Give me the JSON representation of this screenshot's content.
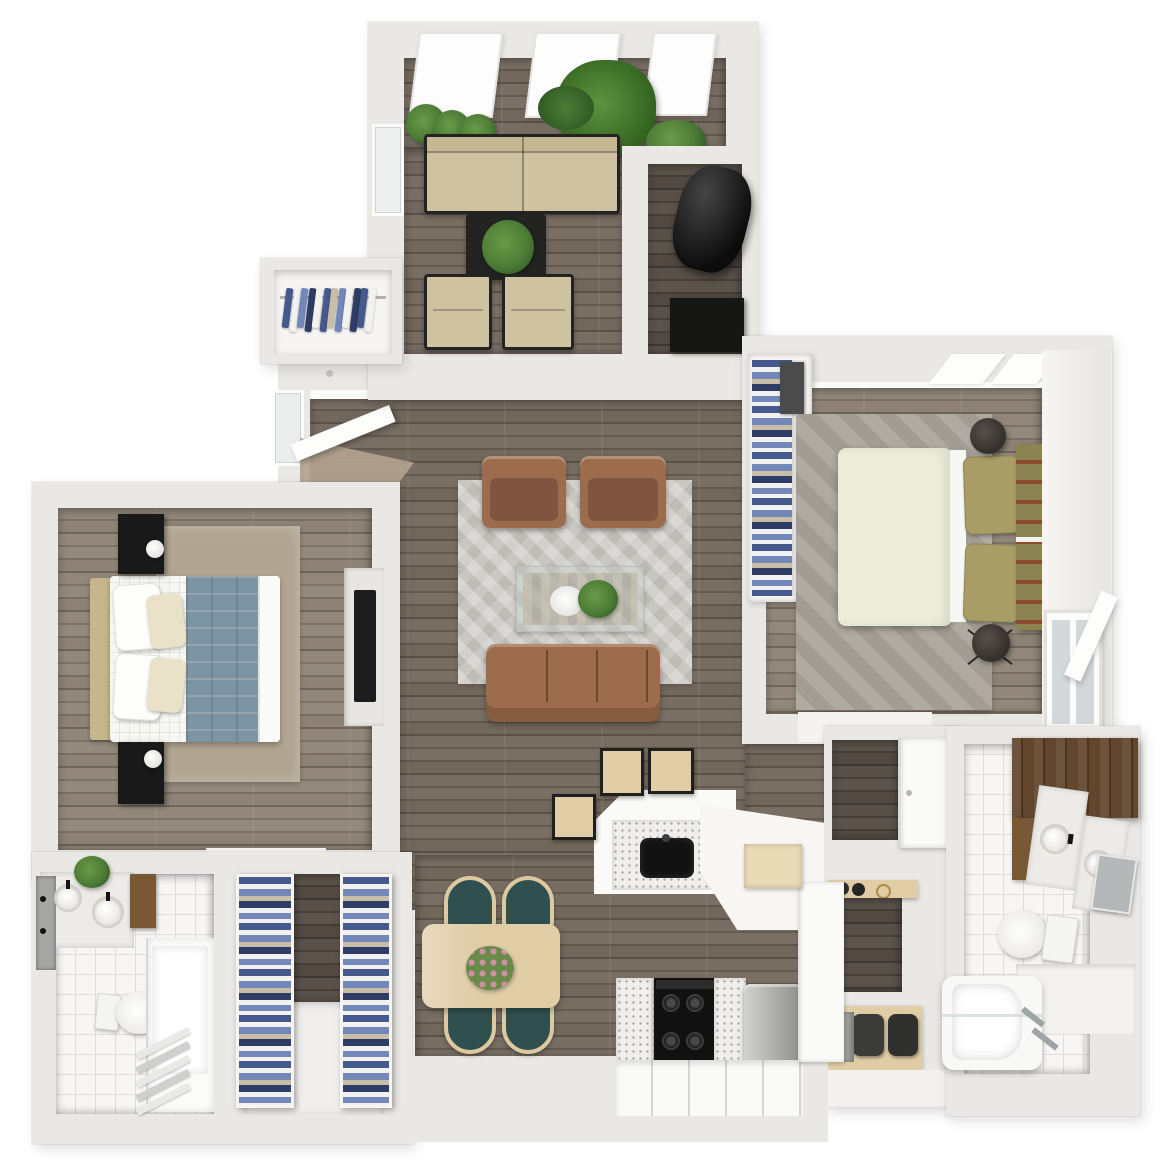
{
  "title": "3d-apartment-floor-plan-render",
  "palette": {
    "bg": "#ffffff",
    "wall": "#eae8e4",
    "wallLight": "#f5f4f2",
    "wallFace": "#fbfbf9",
    "woodBase": "#6f6459",
    "woodLight": "#8b8072",
    "woodDarker": "#4f463e",
    "woodEntry": "#b2a28e",
    "rugLiving": "#c9c7c2",
    "rugBeige": "#b1a591",
    "rugGray": "#a29c93",
    "sofaBrown": "#9c6c4c",
    "sofaBrownDark": "#7f5540",
    "beigeSofa": "#cfc2a0",
    "beigeSeat": "#c4b691",
    "frameBlack": "#232321",
    "plantGreen": "#4d7c36",
    "plantDark": "#335c26",
    "bedCream": "#ecedd9",
    "oliveHead": "#8c8352",
    "olivePillow": "#a89d67",
    "rust": "#8a4c2a",
    "bedWhite": "#f6f6f3",
    "throwBlue": "#7d94a2",
    "headTan": "#c7b68c",
    "tile": "#f7f6f5",
    "tileLine": "#e1deda",
    "marble": "#edebe7",
    "walnut": "#5c4026",
    "walnutLight": "#7a5836",
    "steel": "#a9a9a7",
    "stoveBlack": "#111111",
    "speckleBase": "#efeeeb",
    "cabinetWhite": "#fafaf8",
    "tableWood": "#e0cda6",
    "tableWoodLight": "#e9dab6",
    "chairTeal": "#30504f",
    "linenBlue": "#46598c",
    "linenBlue2": "#7388b8",
    "linenWhite": "#f1f1ef",
    "linenTan": "#c8bea7",
    "navy": "#2e3c66",
    "blackish": "#161614",
    "glassBlue": "#d3d9db",
    "mirrorGray": "#a5a5a3"
  },
  "scene": {
    "type": "apartment-floor-plan-top-view",
    "rooms": [
      {
        "name": "sunroom-lounge",
        "floor": "dark-wood",
        "furniture": [
          "loveseat",
          "coffee-table",
          "lounge-chair",
          "lounge-chair",
          "potted-plant",
          "potted-plant",
          "potted-plant",
          "palm-plant",
          "monstera-plant",
          "skylight",
          "skylight",
          "skylight",
          "window"
        ]
      },
      {
        "name": "utility-closet",
        "floor": "dark-wood",
        "furniture": [
          "water-heater",
          "storage-box"
        ]
      },
      {
        "name": "entry-closet",
        "floor": "white",
        "furniture": [
          "hanging-clothes-rail",
          "hanging-shirts"
        ]
      },
      {
        "name": "living-room",
        "floor": "dark-wood",
        "furniture": [
          "chevron-area-rug",
          "armchair",
          "armchair",
          "glass-coffee-table",
          "centerpiece-plant",
          "white-flowers",
          "three-seat-sofa",
          "entry-door"
        ]
      },
      {
        "name": "bedroom-left",
        "floor": "wood",
        "furniture": [
          "queen-bed",
          "blue-throw-blanket",
          "nightstand",
          "nightstand",
          "table-lamp",
          "table-lamp",
          "area-rug",
          "media-console",
          "tv"
        ]
      },
      {
        "name": "bathroom-left",
        "floor": "white-tile",
        "furniture": [
          "double-sink-vanity",
          "mirror",
          "sconces",
          "plant",
          "medicine-cabinet",
          "toilet",
          "glass-shower",
          "towel-ladder"
        ]
      },
      {
        "name": "linen-closet",
        "floor": "wood-and-white",
        "furniture": [
          "linen-shelving-unit",
          "linen-shelving-unit"
        ]
      },
      {
        "name": "bedroom-right",
        "floor": "wood",
        "furniture": [
          "queen-bed-cream-duvet",
          "olive-headboard",
          "olive-pillows",
          "closet-shelves-folded-clothes",
          "area-rug",
          "round-stool",
          "round-stool",
          "casement-window",
          "skylight",
          "skylight"
        ]
      },
      {
        "name": "bathroom-right",
        "floor": "white-tile",
        "furniture": [
          "walnut-vanity",
          "marble-sink",
          "marble-sink",
          "mirror",
          "toilet",
          "bathtub",
          "glass-screen",
          "chrome-fixtures"
        ]
      },
      {
        "name": "laundry-nook",
        "floor": "dark-wood",
        "furniture": [
          "wall-cabinet",
          "counter-shelf",
          "bowls",
          "brass-ring",
          "wood-bench",
          "pouf",
          "pouf",
          "appliance"
        ]
      },
      {
        "name": "kitchen",
        "floor": "dark-wood",
        "furniture": [
          "peninsula-counter",
          "undermount-black-sink",
          "bar-stool",
          "bar-stool",
          "bar-stool",
          "cooktop-four-burners",
          "speckled-counters",
          "stainless-trash-can",
          "base-cabinet-drawers",
          "tall-cabinet",
          "wood-shelf"
        ]
      },
      {
        "name": "dining-area",
        "floor": "dark-wood",
        "furniture": [
          "light-wood-table",
          "flower-centerpiece",
          "dining-chair",
          "dining-chair",
          "dining-chair",
          "dining-chair"
        ]
      }
    ]
  }
}
